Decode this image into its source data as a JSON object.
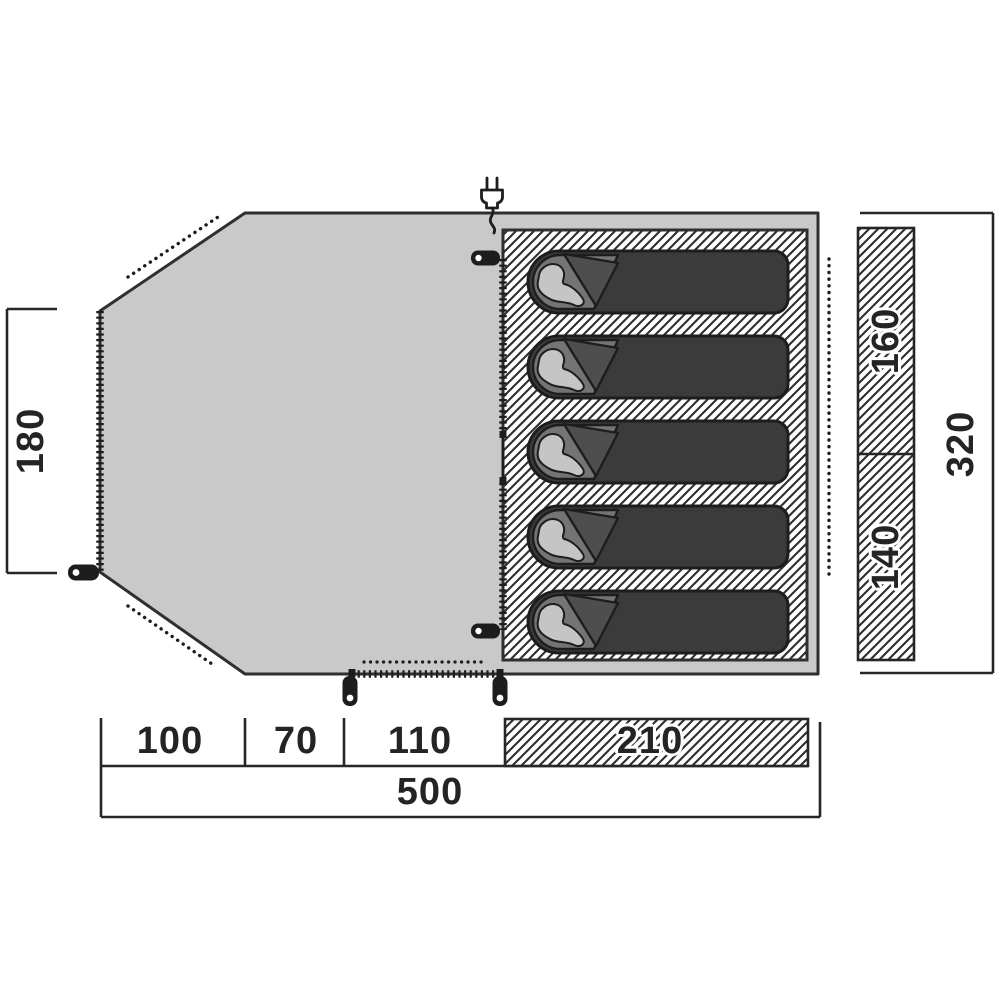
{
  "diagram_type": "tent floor plan",
  "labels": {
    "porch_depth": "180",
    "berth_width_top": "160",
    "berth_width_bottom": "140",
    "depth_total": "320",
    "seg_porch_left": "100",
    "seg_porch_mid": "70",
    "seg_porch_right": "110",
    "seg_cabin": "210",
    "length_total": "500"
  },
  "icons": {
    "power_plug": "power-plug-icon (two-prong plug with cable squiggle, svg shape)",
    "tent_peg": "tent-peg-icon (black rounded stake with eyelet hole, svg shape)",
    "sleeping_bag": "sleeping-bag-icon (dark bag with hood, fold flap and sleeper silhouette, svg shape)"
  },
  "colors": {
    "bg": "#ffffff",
    "floor": "#c9c9c9",
    "outline": "#2f2f2f",
    "ink": "#1d1d1d",
    "line": "#262626",
    "hatch": "#2e2e2e",
    "bag_body": "#3b3b3b",
    "bag_hood": "#747474",
    "bag_flap": "#4e4e4e",
    "person": "#c5c5c5",
    "text": "#242424"
  },
  "counts": {
    "sleeping_bags": 5
  }
}
